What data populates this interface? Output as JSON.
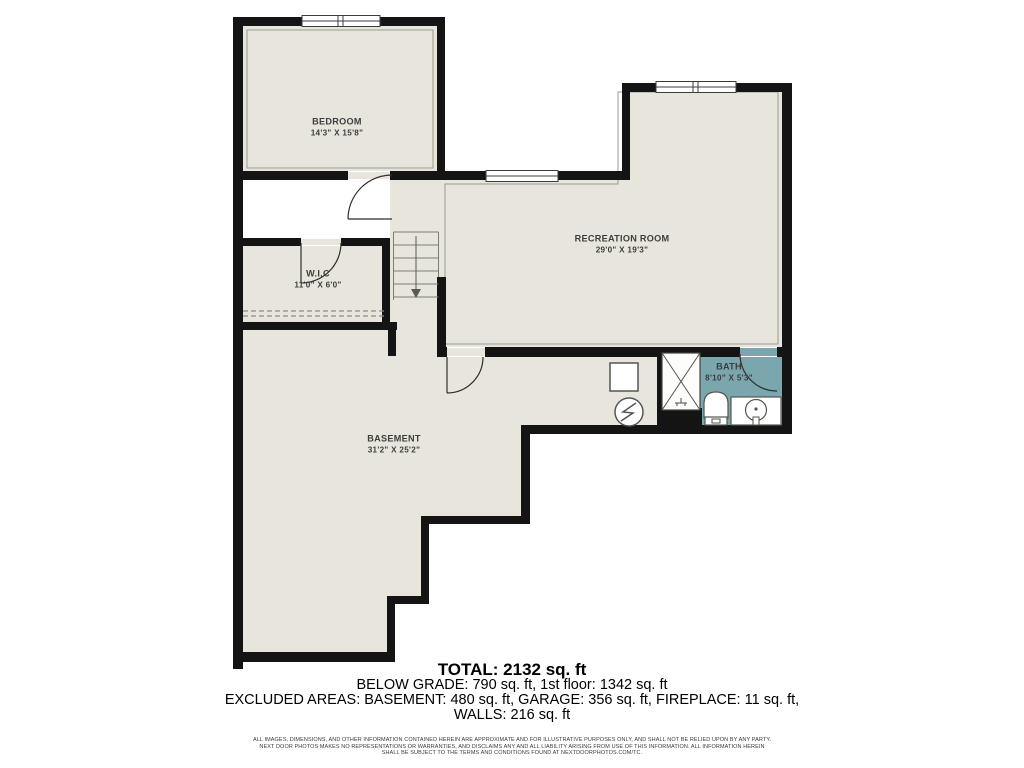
{
  "plan": {
    "title": "Basement floor plan",
    "colors": {
      "floor": "#e8e6dc",
      "wall": "#141414",
      "bath_floor": "#7aa6ae",
      "background": "#ffffff",
      "label_text": "#3d3d3d"
    },
    "rooms": [
      {
        "id": "bedroom",
        "name": "BEDROOM",
        "dims": "14'3\" X 15'8\""
      },
      {
        "id": "wic",
        "name": "W.I.C",
        "dims": "11'0\" X 6'0\""
      },
      {
        "id": "recreation",
        "name": "RECREATION ROOM",
        "dims": "29'0\" X 19'3\""
      },
      {
        "id": "basement",
        "name": "BASEMENT",
        "dims": "31'2\" X 25'2\""
      },
      {
        "id": "bath",
        "name": "BATH",
        "dims": "8'10\" X 5'3\""
      }
    ],
    "symbols": [
      "window",
      "door-swing",
      "stairs-down-arrow",
      "furnace-square",
      "electrical-panel-circle",
      "shower",
      "toilet",
      "sink-vanity",
      "dashed-ceiling-line"
    ]
  },
  "summary": {
    "total": "TOTAL: 2132 sq. ft",
    "below_grade": "BELOW GRADE: 790 sq. ft, 1st floor: 1342 sq. ft",
    "excluded": "EXCLUDED AREAS: BASEMENT: 480 sq. ft, GARAGE: 356 sq. ft, FIREPLACE: 11 sq. ft,",
    "walls": "WALLS: 216 sq. ft"
  },
  "disclaimer": {
    "line1": "ALL IMAGES, DIMENSIONS, AND OTHER INFORMATION CONTAINED HEREIN ARE APPROXIMATE AND FOR ILLUSTRATIVE PURPOSES ONLY, AND SHALL NOT BE RELIED UPON BY ANY PARTY.",
    "line2": "NEXT DOOR PHOTOS MAKES NO REPRESENTATIONS OR WARRANTIES, AND DISCLAIMS ANY AND ALL LIABILITY ARISING FROM USE OF THIS INFORMATION. ALL INFORMATION HEREIN",
    "line3": "SHALL BE SUBJECT TO THE TERMS AND CONDITIONS FOUND AT NEXTDOORPHOTOS.COM/TC."
  }
}
